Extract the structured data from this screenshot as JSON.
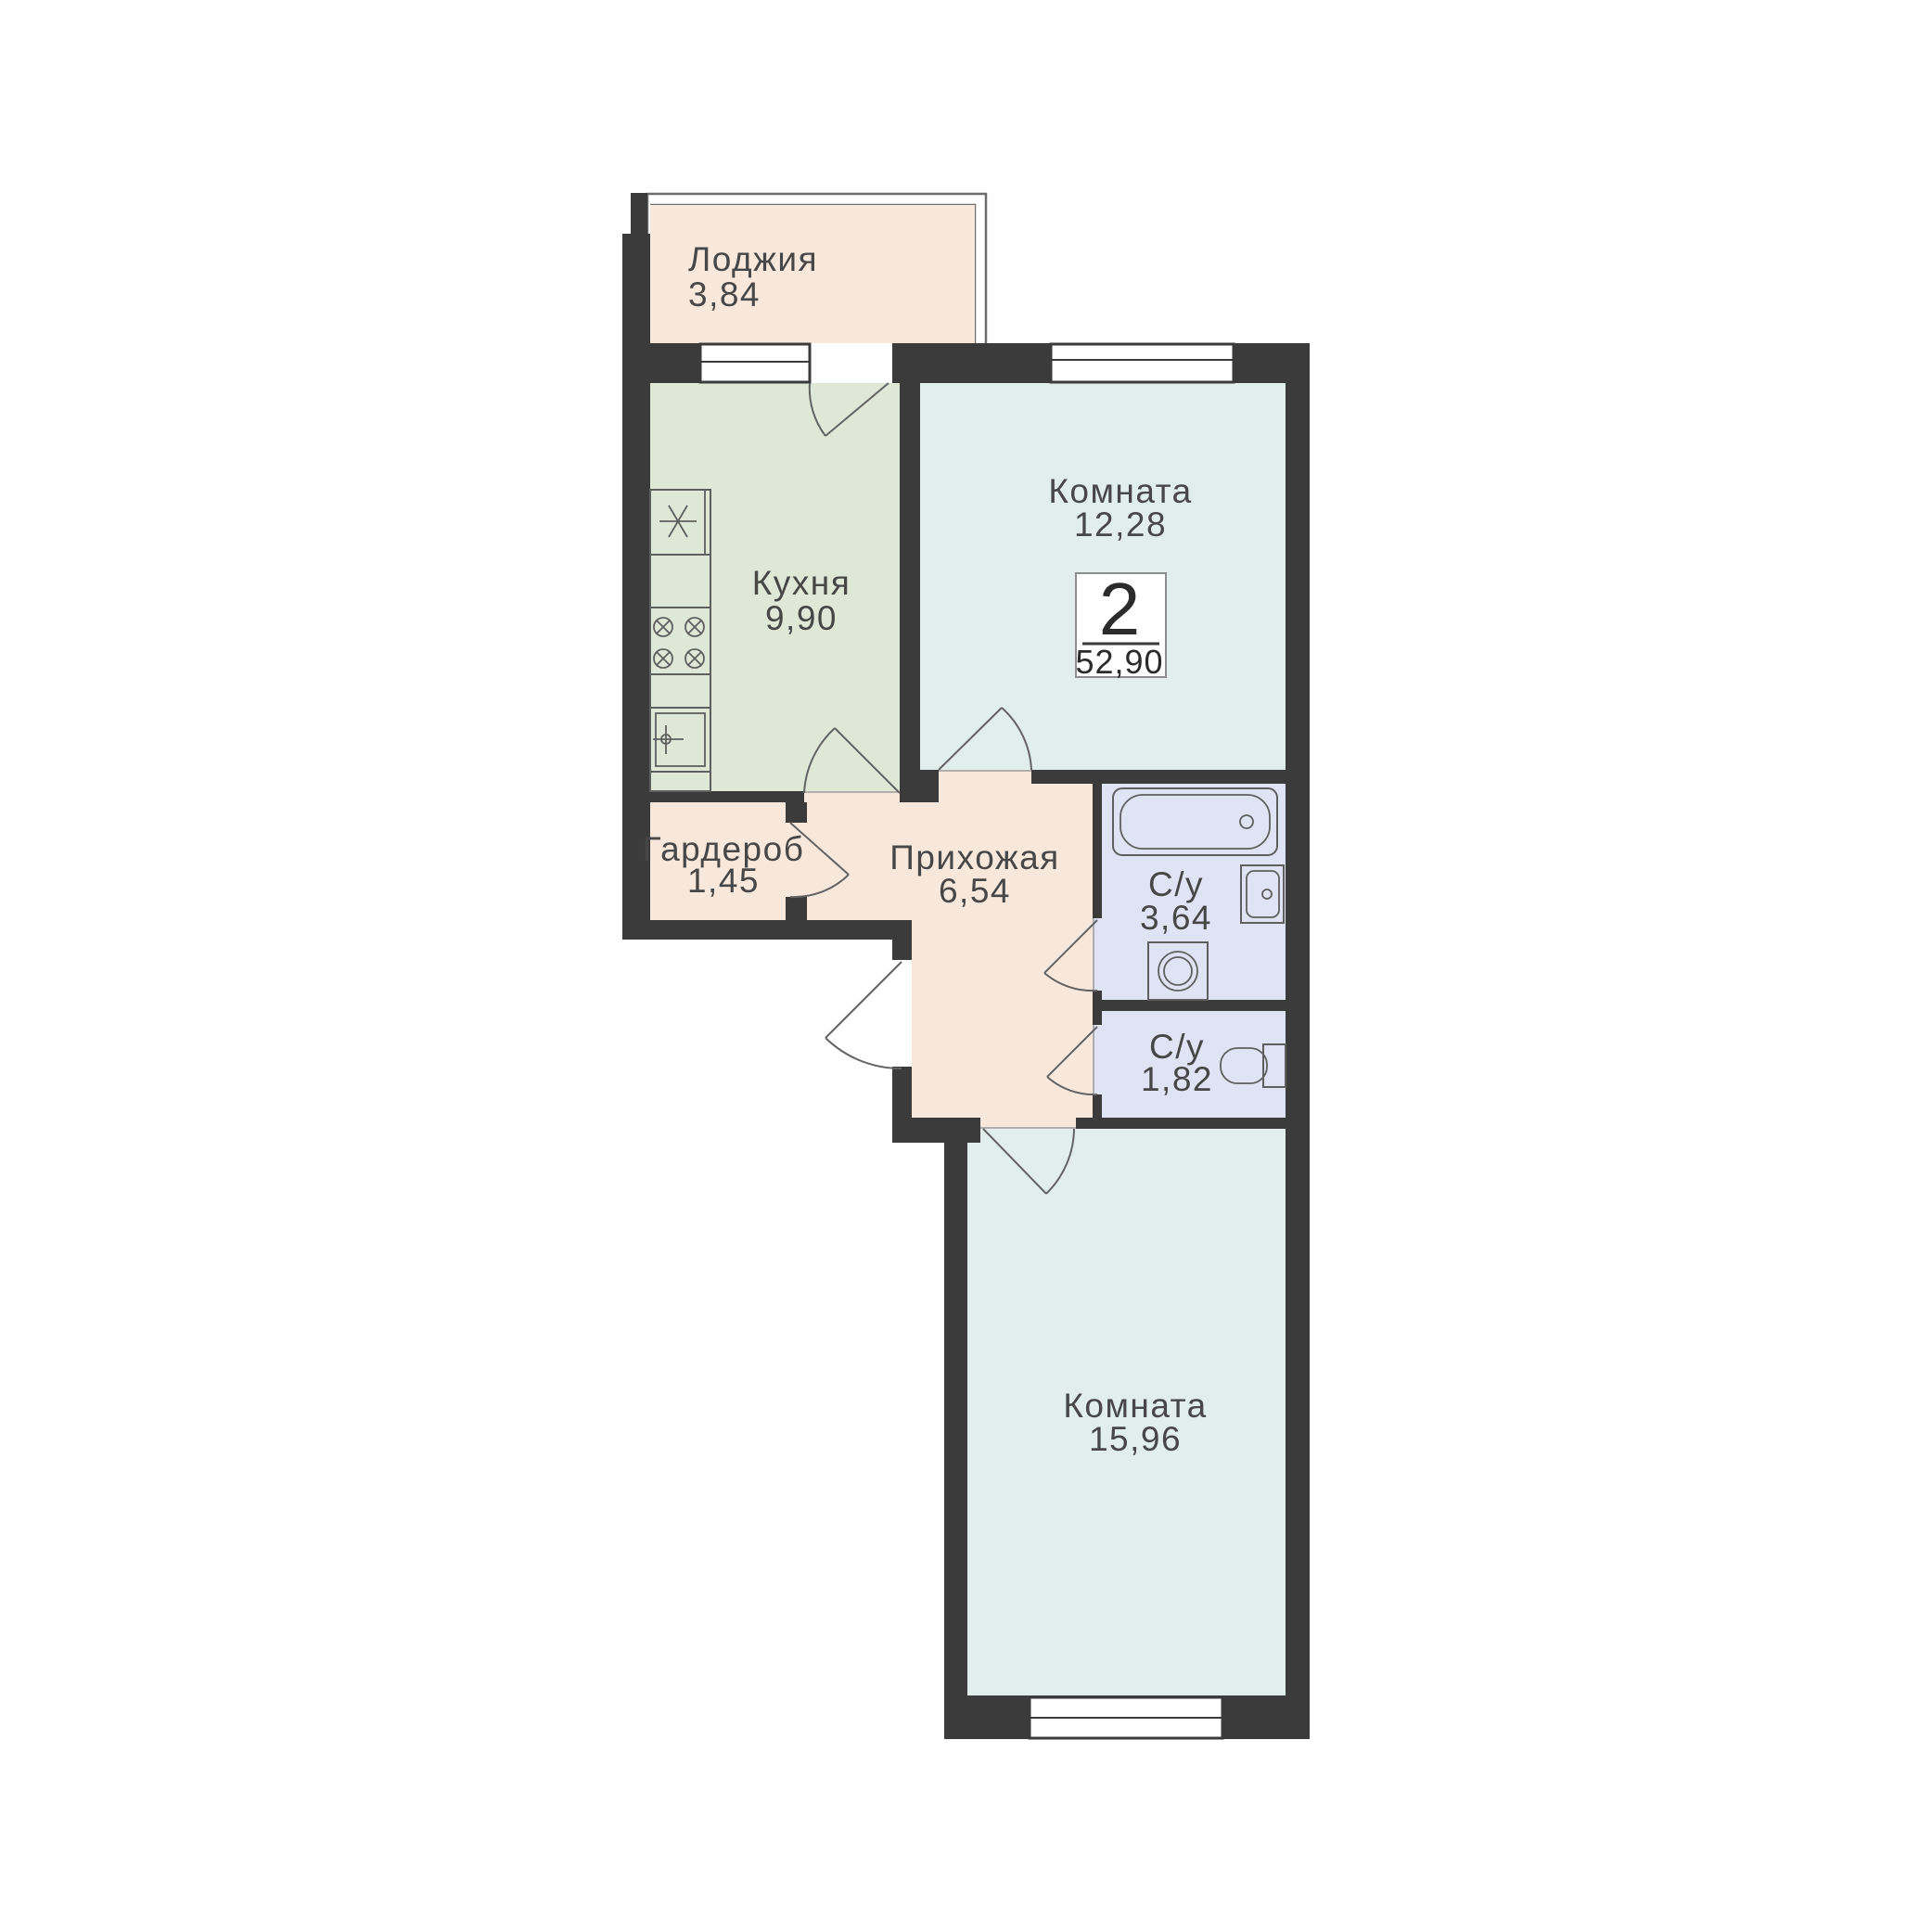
{
  "plan": {
    "title": "2-room apartment floor plan",
    "badge": {
      "rooms_count": "2",
      "total_area": "52,90"
    },
    "rooms": [
      {
        "id": "loggia",
        "label": "Лоджия",
        "area": "3,84"
      },
      {
        "id": "kitchen",
        "label": "Кухня",
        "area": "9,90"
      },
      {
        "id": "room-1",
        "label": "Комната",
        "area": "12,28"
      },
      {
        "id": "wardrobe",
        "label": "Гардероб",
        "area": "1,45"
      },
      {
        "id": "hallway",
        "label": "Прихожая",
        "area": "6,54"
      },
      {
        "id": "bathroom",
        "label": "С/у",
        "area": "3,64"
      },
      {
        "id": "wc",
        "label": "С/у",
        "area": "1,82"
      },
      {
        "id": "room-2",
        "label": "Комната",
        "area": "15,96"
      }
    ],
    "colors": {
      "wall": "#3b3b3c",
      "pink": "#f8e8dc",
      "green": "#dfe8d7",
      "blue": "#e1eeec",
      "lavender": "#e0e3f4",
      "window": "#ffffff",
      "badge_bg": "#ffffff",
      "text": "#474747",
      "badge_text": "#2b2b2b"
    },
    "fixtures": [
      "kitchen-sink",
      "stove-4-burners",
      "fridge",
      "bathtub",
      "wash-basin",
      "washing-machine",
      "toilet"
    ]
  }
}
